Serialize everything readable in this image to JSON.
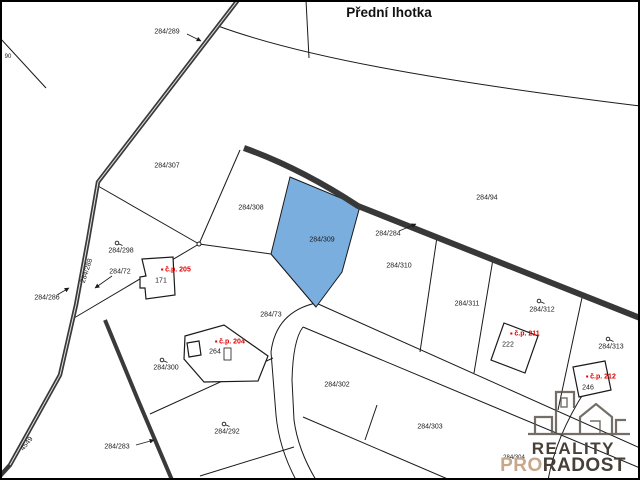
{
  "title": "Přední lhotka",
  "colors": {
    "highlight": "#7aaede",
    "road": "#3a3a3a",
    "boundary_line": "#1a1a1a",
    "house_number_red": "#dd0000",
    "logo_dark": "#474038",
    "logo_accent": "#c7a88a"
  },
  "map": {
    "highlighted_parcel": "284/309",
    "parcel_labels": [
      {
        "text": "284/289",
        "x": 167,
        "y": 32
      },
      {
        "text": "90",
        "x": 8,
        "y": 57,
        "size": 6
      },
      {
        "text": "284/307",
        "x": 167,
        "y": 166
      },
      {
        "text": "284/308",
        "x": 251,
        "y": 208
      },
      {
        "text": "284/309",
        "x": 322,
        "y": 240
      },
      {
        "text": "284/94",
        "x": 487,
        "y": 198
      },
      {
        "text": "284/284",
        "x": 388,
        "y": 234
      },
      {
        "text": "284/310",
        "x": 399,
        "y": 266
      },
      {
        "text": "284/311",
        "x": 467,
        "y": 304
      },
      {
        "text": "284/312",
        "x": 542,
        "y": 310
      },
      {
        "text": "284/313",
        "x": 611,
        "y": 347
      },
      {
        "text": "284/298",
        "x": 121,
        "y": 251
      },
      {
        "text": "284/72",
        "x": 120,
        "y": 272
      },
      {
        "text": "284/286",
        "x": 47,
        "y": 298
      },
      {
        "text": "284/288",
        "x": 87,
        "y": 271,
        "rotate": -72
      },
      {
        "text": "284/73",
        "x": 271,
        "y": 315
      },
      {
        "text": "284/300",
        "x": 166,
        "y": 368
      },
      {
        "text": "284/302",
        "x": 337,
        "y": 385
      },
      {
        "text": "284/303",
        "x": 430,
        "y": 427
      },
      {
        "text": "284/304",
        "x": 514,
        "y": 458,
        "size": 6
      },
      {
        "text": "284/292",
        "x": 227,
        "y": 432
      },
      {
        "text": "284/283",
        "x": 117,
        "y": 447
      },
      {
        "text": "4549",
        "x": 27,
        "y": 444,
        "rotate": -52
      },
      {
        "text": "171",
        "x": 161,
        "y": 281
      },
      {
        "text": "264",
        "x": 215,
        "y": 352
      },
      {
        "text": "222",
        "x": 508,
        "y": 345
      },
      {
        "text": "246",
        "x": 588,
        "y": 388
      }
    ],
    "house_numbers": [
      {
        "text": "č.p. 205",
        "x": 176,
        "y": 270,
        "cls": "cp",
        "color": "#dd0000"
      },
      {
        "text": "č.p. 204",
        "x": 230,
        "y": 342,
        "cls": "cp",
        "color": "#dd0000"
      },
      {
        "text": "č.p. 211",
        "x": 525,
        "y": 334,
        "cls": "cp",
        "color": "#dd0000"
      },
      {
        "text": "č.p. 212",
        "x": 601,
        "y": 377,
        "cls": "cp",
        "color": "#dd0000"
      }
    ]
  },
  "logo": {
    "line1": "REALITY",
    "line2_accent": "PRO",
    "line2_rest": "RADOST"
  }
}
